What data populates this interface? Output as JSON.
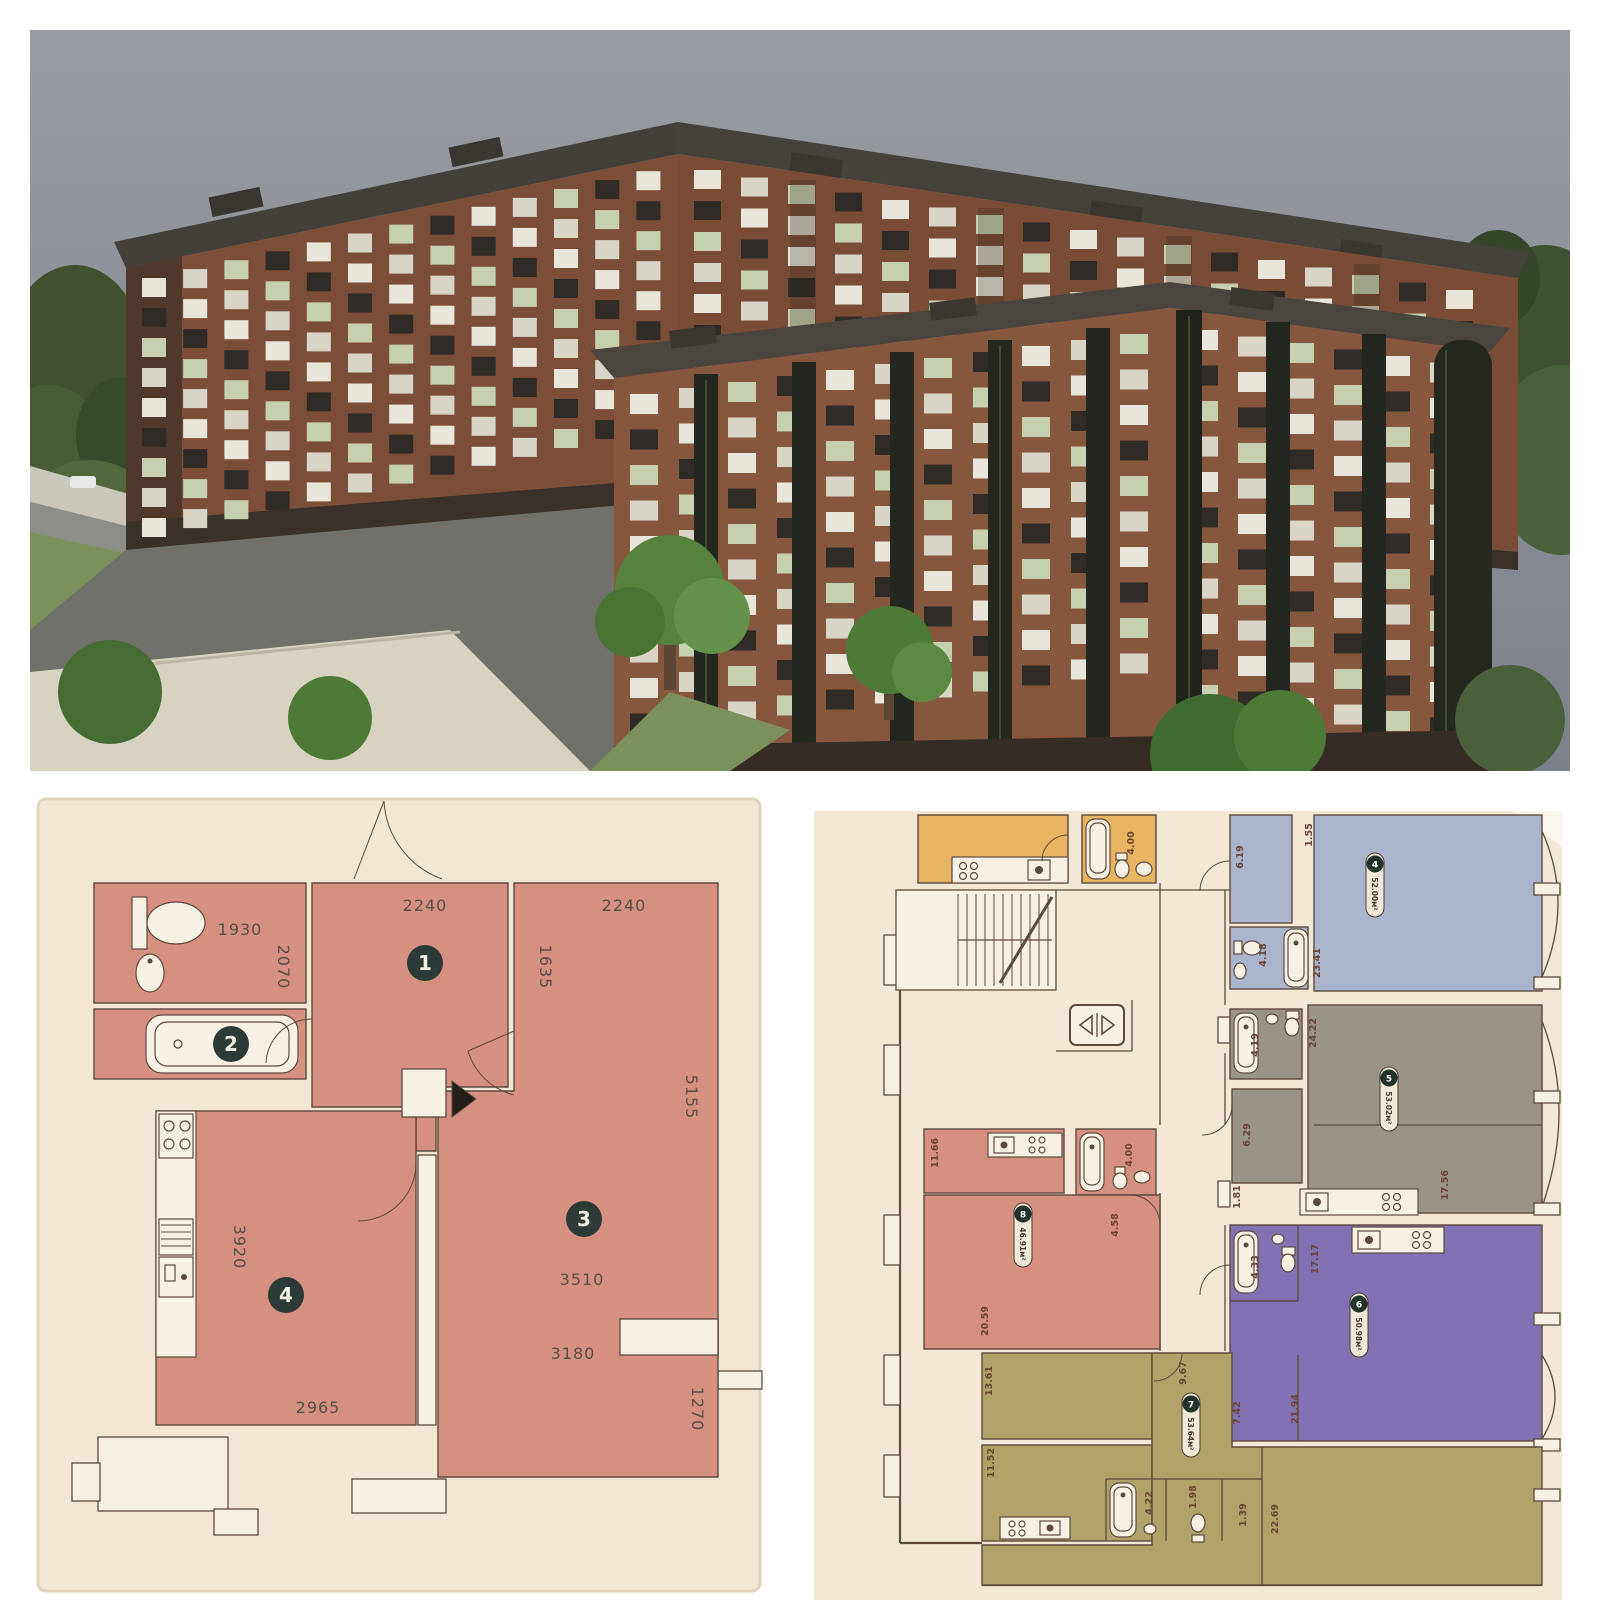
{
  "photo": {
    "description": "3D architectural rendering of a U-shaped multi-storey brick apartment complex with courtyard, playground and trees",
    "colors": {
      "sky": "#8b9097",
      "brick": "#7d4e37",
      "brick_front": "#87573d",
      "roof": "#45423b",
      "glass": "#23271f",
      "tree": "#4e7a38",
      "lawn": "#7c905c",
      "asphalt": "#6f716a",
      "plaza": "#d8d2c0"
    }
  },
  "left_plan": {
    "badges": {
      "b1": "1",
      "b2": "2",
      "b3": "3",
      "b4": "4"
    },
    "dims": {
      "bath_w": "1930",
      "bath_h": "2070",
      "hall_w": "2240",
      "room3_w_top": "2240",
      "hall_h": "1635",
      "room3_h": "5155",
      "kitchen_h": "3920",
      "room3_w": "3510",
      "room3_w_low": "3180",
      "kitchen_w": "2965",
      "niche_h": "1270"
    }
  },
  "right_plan": {
    "orange": {
      "bath_area": "4.00"
    },
    "apt4": {
      "num": "4",
      "area": "52.00м²",
      "hall": "6.19",
      "top": "1.55",
      "bath": "4.18",
      "room": "23.41"
    },
    "apt5": {
      "num": "5",
      "area": "53.02м²",
      "top": "24.22",
      "bath": "4.19",
      "hall": "6.29",
      "room": "17.56",
      "small": "1.81"
    },
    "apt6": {
      "num": "6",
      "area": "50.98м²",
      "bath": "4.33",
      "kitchen": "17.17",
      "small": "7.42",
      "room": "21.94"
    },
    "apt7": {
      "num": "7",
      "area": "53.64м²",
      "room1": "13.61",
      "room2": "11.52",
      "hall": "9.67",
      "bath": "4.22",
      "wc": "1.98",
      "small": "1.39",
      "room3": "22.69"
    },
    "apt8": {
      "num": "8",
      "area": "46.91м²",
      "kitchen": "11.66",
      "bath": "4.00",
      "hall": "4.58",
      "room": "20.59"
    }
  }
}
